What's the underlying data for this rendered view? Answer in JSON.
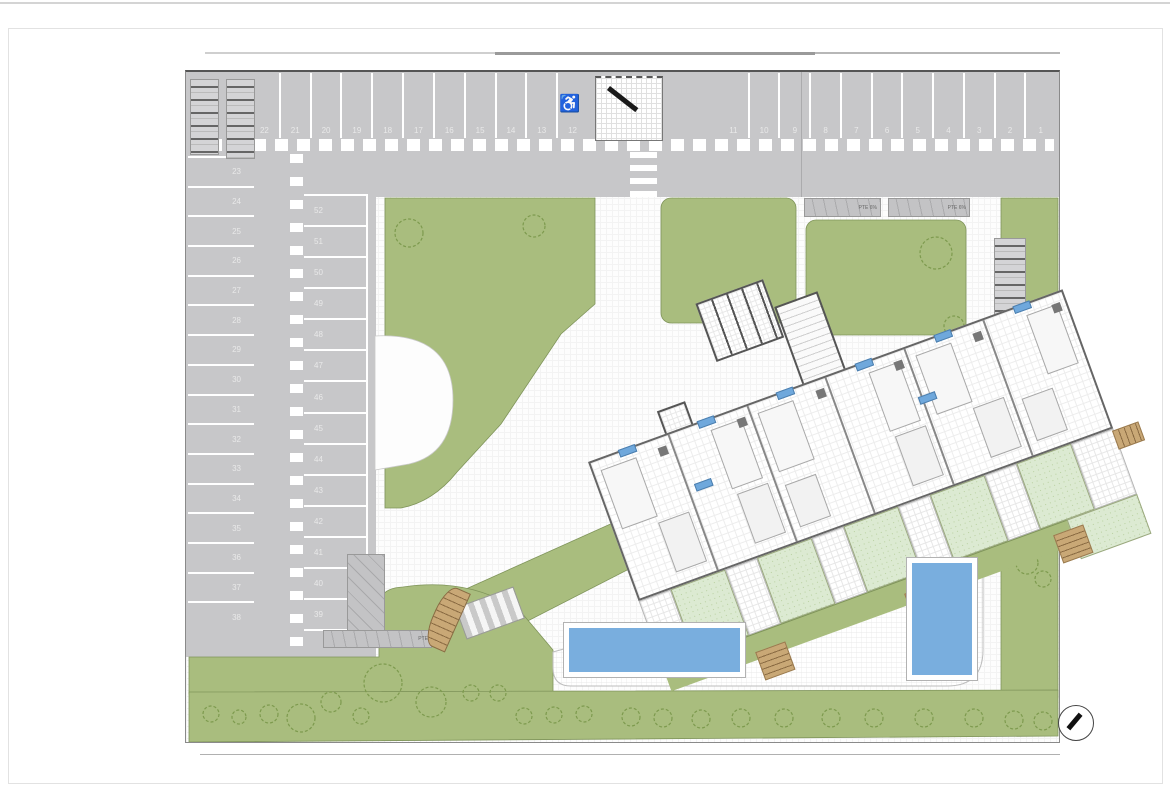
{
  "colors": {
    "asphalt": "#c7c7c9",
    "lawn": "#a9bd7e",
    "terrace": "#dcead2",
    "pool": "#79aede",
    "accent-blue": "#6fa8dc",
    "deck-wood": "#c9a876"
  },
  "parking": {
    "top_row_left": [
      "22",
      "21",
      "20",
      "19",
      "18",
      "17",
      "16",
      "15",
      "14",
      "13",
      "12"
    ],
    "top_row_right": [
      "11",
      "10",
      "9",
      "8",
      "7",
      "6",
      "5",
      "4",
      "3",
      "2",
      "1"
    ],
    "left_column": [
      "23",
      "24",
      "25",
      "26",
      "27",
      "28",
      "29",
      "30",
      "31",
      "32",
      "33",
      "34",
      "35",
      "36",
      "37",
      "38"
    ],
    "middle_column": [
      "52",
      "51",
      "50",
      "49",
      "48",
      "47",
      "46",
      "45",
      "44",
      "43",
      "42",
      "41",
      "40",
      "39"
    ],
    "accessible_icon": "♿"
  },
  "labels": {
    "ramp_ne_1": "PTE 6%",
    "ramp_ne_2": "PTE 6%",
    "ramp_w": "PTE"
  }
}
